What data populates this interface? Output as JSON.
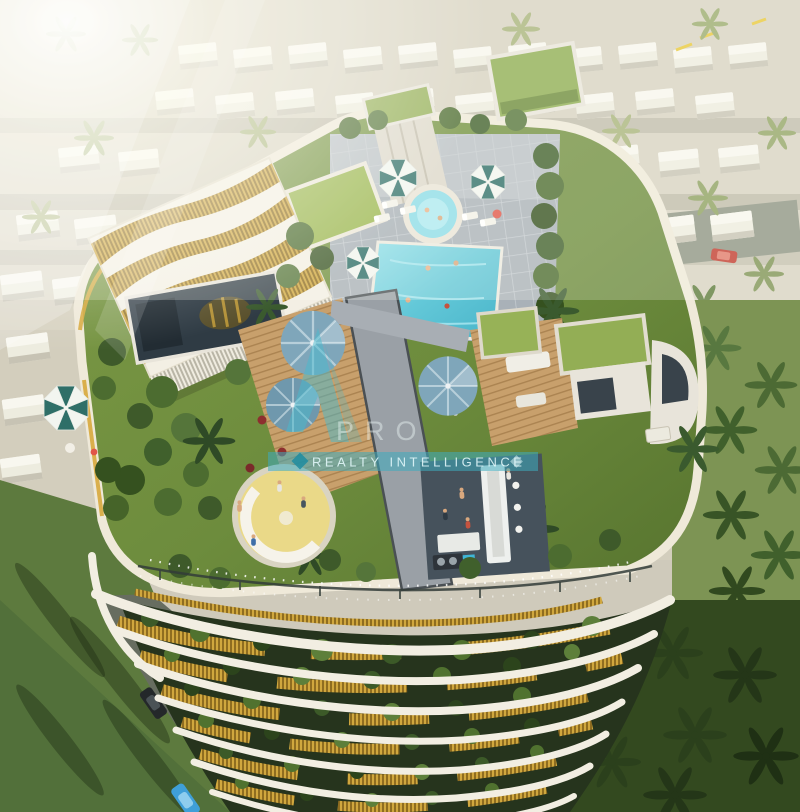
{
  "watermark": {
    "logo_text": "PRO",
    "tagline": "REALTY INTELLIGENCE",
    "accent_color": "#3aacc1",
    "band_color": "#37a2b6"
  },
  "scene": {
    "type": "aerial-architectural-render",
    "subject": "Rooftop amenity deck of a curved gold-louvered residential tower overlooking a sunlit villa community with palm trees",
    "features": [
      "swimming-pool",
      "jacuzzi",
      "teal-striped-umbrellas",
      "steel-blue-umbrellas",
      "wavy-gold-pergola",
      "glass-pavilion",
      "sunken-yellow-lounge",
      "bbq-bar-counter",
      "green-roof-boxes",
      "palm-trees",
      "villa-rows",
      "curved-white-balconies",
      "roads-with-cars",
      "sun-loungers",
      "people"
    ],
    "palette": {
      "pool_water": "#63c8d8",
      "rooftop_lawn": "#6d8c3d",
      "wood_deck": "#c8a06c",
      "gold_louvers": "#c5912e",
      "facade_white": "#f2eee2",
      "umbrella_teal": "#2f6f68",
      "umbrella_blue": "#7fa6ba",
      "foliage_dark": "#2f4a26",
      "community_ground": "#d3cebd"
    }
  }
}
